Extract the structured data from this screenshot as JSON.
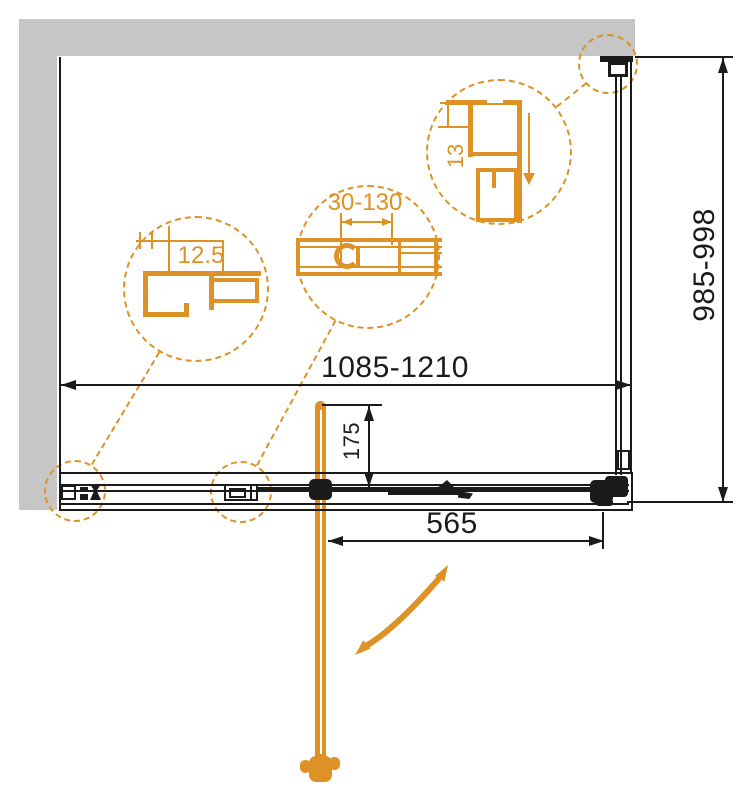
{
  "drawing": {
    "colors": {
      "accent_orange": "#DE9226",
      "wall_gray": "#C6C6C6",
      "line_black": "#1B1B1B"
    },
    "dimensions": {
      "overall_width": "1085-1210",
      "side_depth": "985-998",
      "door_opening": "565",
      "handle_offset": "175"
    },
    "details": {
      "wall_profile": "12.5",
      "adjustment_range": "30-130",
      "top_profile": "13"
    }
  }
}
